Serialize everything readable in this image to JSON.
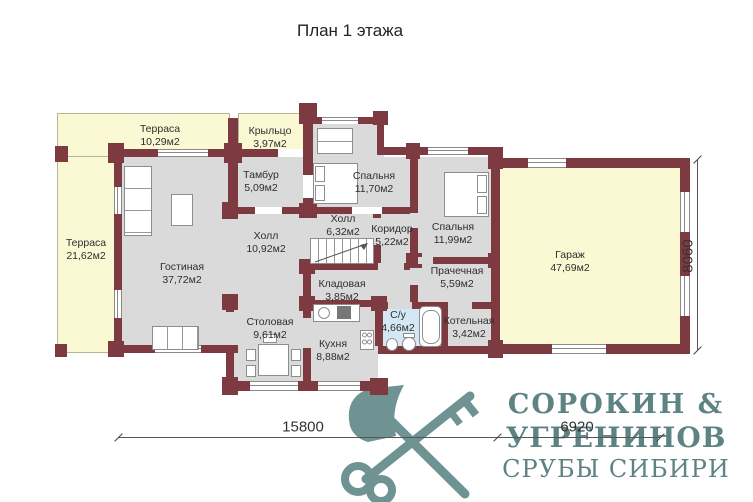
{
  "title": "План 1 этажа",
  "rooms": [
    {
      "name": "Терраса",
      "area": "10,29м2"
    },
    {
      "name": "Крыльцо",
      "area": "3,97м2"
    },
    {
      "name": "Терраса",
      "area": "21,62м2"
    },
    {
      "name": "Тамбур",
      "area": "5,09м2"
    },
    {
      "name": "Спальня",
      "area": "11,70м2"
    },
    {
      "name": "Холл",
      "area": "6,32м2"
    },
    {
      "name": "Холл",
      "area": "10,92м2"
    },
    {
      "name": "Коридор",
      "area": "5,22м2"
    },
    {
      "name": "Спальня",
      "area": "11,99м2"
    },
    {
      "name": "Гостиная",
      "area": "37,72м2"
    },
    {
      "name": "Кладовая",
      "area": "3,85м2"
    },
    {
      "name": "Прачечная",
      "area": "5,59м2"
    },
    {
      "name": "Столовая",
      "area": "9,61м2"
    },
    {
      "name": "Кухня",
      "area": "8,88м2"
    },
    {
      "name": "С/у",
      "area": "4,66м2"
    },
    {
      "name": "Котельная",
      "area": "3,42м2"
    },
    {
      "name": "Гараж",
      "area": "47,69м2"
    }
  ],
  "dimensions": {
    "total_width": "15800",
    "garage_width": "6920",
    "right_height": "8060"
  },
  "logo": {
    "line1": "СОРОКИН &",
    "line2": "УГРЕНИНОВ",
    "line3": "СРУБЫ СИБИРИ",
    "graphic": "crossed-axe-and-key-icon"
  },
  "colors": {
    "wall": "#7d3a41",
    "terrace_fill": "#fbf9d3",
    "room_fill": "#dadada",
    "bathroom_fill": "#d3e8f4",
    "logo_text": "#5e8383",
    "logo_graphic": "#6f9292",
    "label_text": "#2e2e2e"
  }
}
